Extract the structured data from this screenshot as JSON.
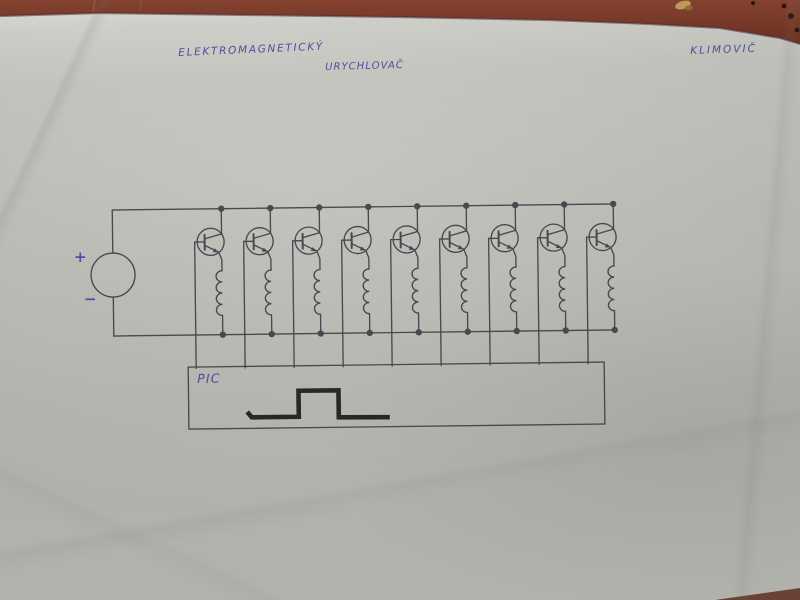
{
  "scene": {
    "type": "photograph of a hand-drawn circuit schematic on a sheet of paper lying on a wooden table",
    "paper_color": "#b4b4ae",
    "table_color": "#7a3b29"
  },
  "annotations": {
    "ink_color": "#4a4f9e",
    "title_line1": "ELEKTROMAGNETICKÝ",
    "title_line2": "URYCHLOVAČ",
    "author": "KLIMOVIČ"
  },
  "circuit": {
    "ink_color": "#3f3f47",
    "pulse_color": "#1c1c1c",
    "stage_count": 9,
    "source_plus": "+",
    "source_minus": "−",
    "controller_label": "PIC",
    "components": {
      "power_source": "dc-source-circle",
      "switch": "npn-transistor",
      "load": "coil-electromagnet",
      "controller": "pic-microcontroller-box",
      "waveform": "square-pulse"
    }
  }
}
